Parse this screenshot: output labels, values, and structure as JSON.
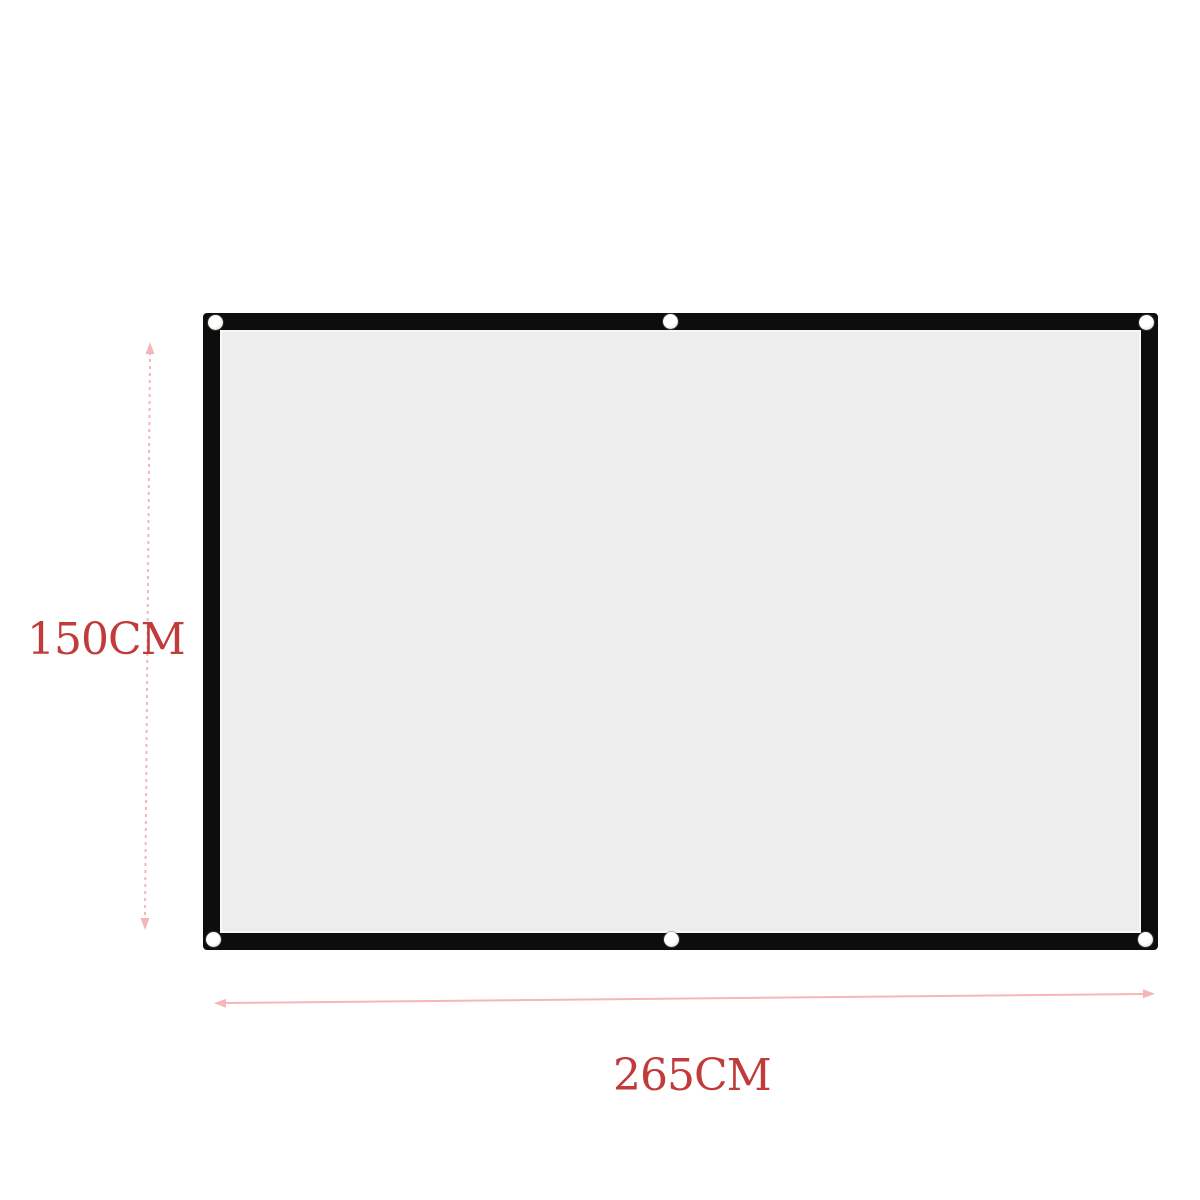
{
  "dimensions": {
    "height_label": "150CM",
    "width_label": "265CM"
  },
  "icons": {
    "height_arrow": "vertical-double-arrow-dotted",
    "width_arrow": "horizontal-double-arrow",
    "grommets": [
      "top-left",
      "top-center",
      "top-right",
      "bottom-left",
      "bottom-center",
      "bottom-right"
    ]
  },
  "colors": {
    "background": "#ffffff",
    "frame_black": "#0d0d0d",
    "screen_gray": "#ededee",
    "label_red": "#c13b3b",
    "arrow_pink": "#f4b6b6"
  }
}
